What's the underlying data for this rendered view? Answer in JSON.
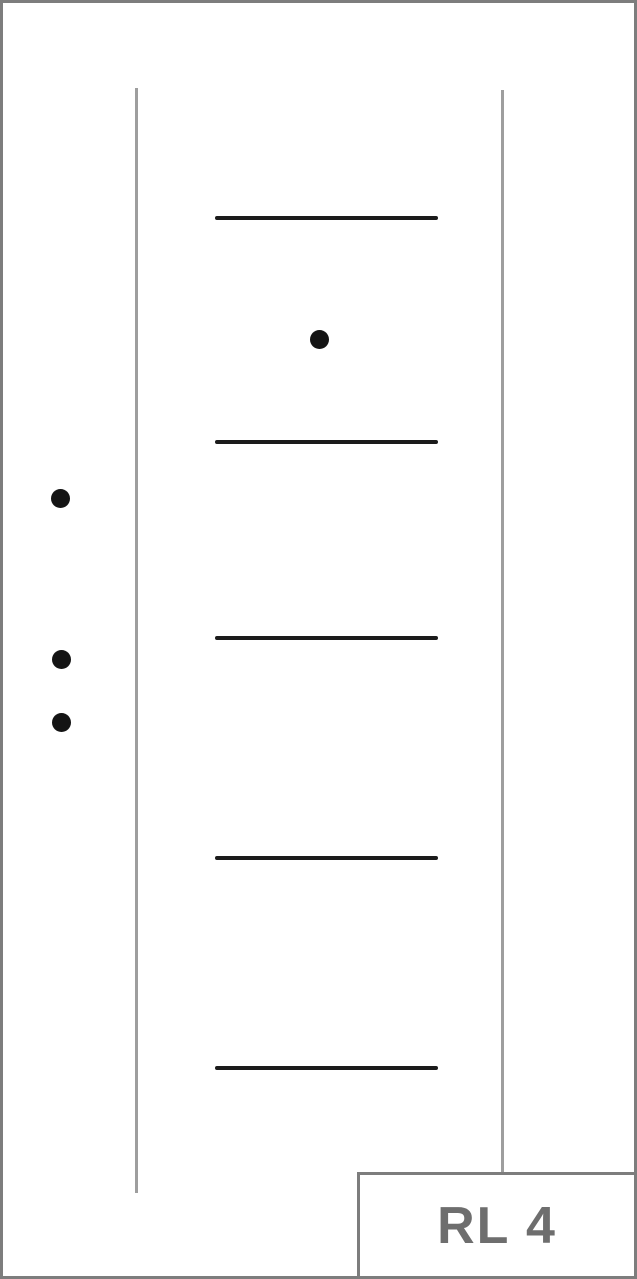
{
  "diagram": {
    "label": "RL 4",
    "colors": {
      "background": "#ffffff",
      "frame_border": "#7d7d7d",
      "vertical_line": "#9e9e9e",
      "horizontal_line": "#1b1b1b",
      "dot": "#141414",
      "label_border": "#7d7d7d",
      "label_text": "#6e6e6e"
    },
    "frame_border_width": 3,
    "vertical_lines": [
      {
        "x": 136,
        "y1": 88,
        "y2": 1193
      },
      {
        "x": 502,
        "y1": 90,
        "y2": 1172
      }
    ],
    "horizontal_lines": [
      {
        "x1": 215,
        "x2": 438,
        "y": 218
      },
      {
        "x1": 215,
        "x2": 438,
        "y": 442
      },
      {
        "x1": 215,
        "x2": 438,
        "y": 638
      },
      {
        "x1": 215,
        "x2": 438,
        "y": 858
      },
      {
        "x1": 215,
        "x2": 438,
        "y": 1068
      }
    ],
    "hline_thickness": 4,
    "vline_width": 3,
    "dots": [
      {
        "cx": 319,
        "cy": 339
      },
      {
        "cx": 60,
        "cy": 498
      },
      {
        "cx": 61,
        "cy": 659
      },
      {
        "cx": 61,
        "cy": 722
      }
    ],
    "dot_diameter": 19,
    "label_box": {
      "left": 357,
      "top": 1172
    }
  }
}
